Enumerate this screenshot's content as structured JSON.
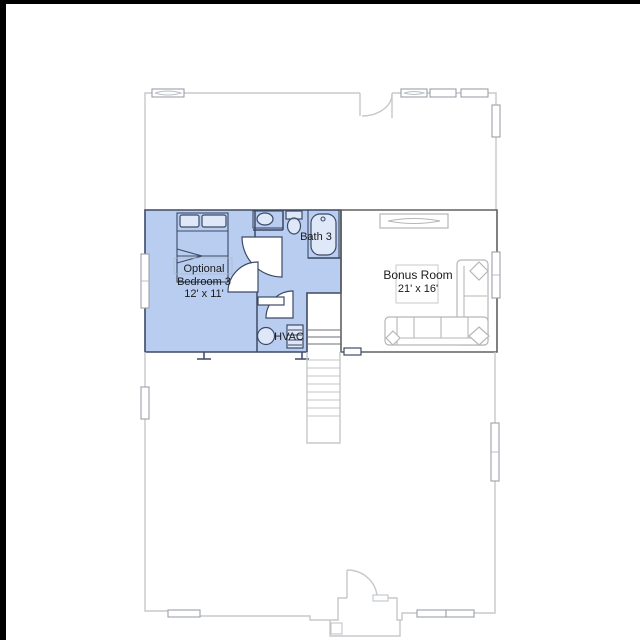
{
  "rooms": {
    "bedroom": {
      "line1": "Optional",
      "line2": "Bedroom 3",
      "dims": "12' x 11'"
    },
    "bath": {
      "label": "Bath 3"
    },
    "bonus": {
      "label": "Bonus Room",
      "dims": "21' x 16'"
    },
    "hvac": {
      "label": "HVAC"
    }
  },
  "colors": {
    "highlight": "#b9cdf0",
    "highlight_wall": "#3d4a66",
    "wall_dark": "#606060",
    "wall_light": "#c8c8c8",
    "furniture": "#b6b6b6",
    "text": "#1b1b1b",
    "frame": "#000000"
  }
}
